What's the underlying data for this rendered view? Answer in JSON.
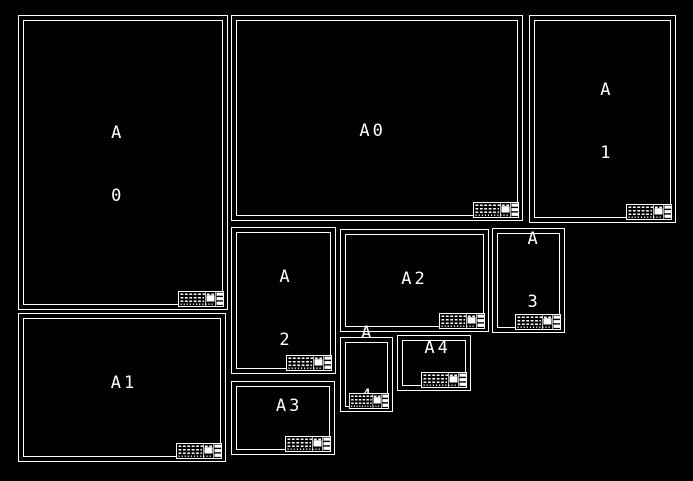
{
  "canvas": {
    "background_color": "#000000",
    "line_color": "#ffffff"
  },
  "sheets": [
    {
      "name": "A0 portrait",
      "line1": "A",
      "line2": "0"
    },
    {
      "name": "A0 landscape",
      "line1": "A0"
    },
    {
      "name": "A1 portrait",
      "line1": "A",
      "line2": "1"
    },
    {
      "name": "A1 landscape",
      "line1": "A1"
    },
    {
      "name": "A2 portrait",
      "line1": "A",
      "line2": "2"
    },
    {
      "name": "A2 landscape",
      "line1": "A2"
    },
    {
      "name": "A3 portrait",
      "line1": "A",
      "line2": "3"
    },
    {
      "name": "A3 landscape",
      "line1": "A3"
    },
    {
      "name": "A4 portrait",
      "line1": "A",
      "line2": "4"
    },
    {
      "name": "A4 landscape",
      "line1": "A4"
    }
  ]
}
